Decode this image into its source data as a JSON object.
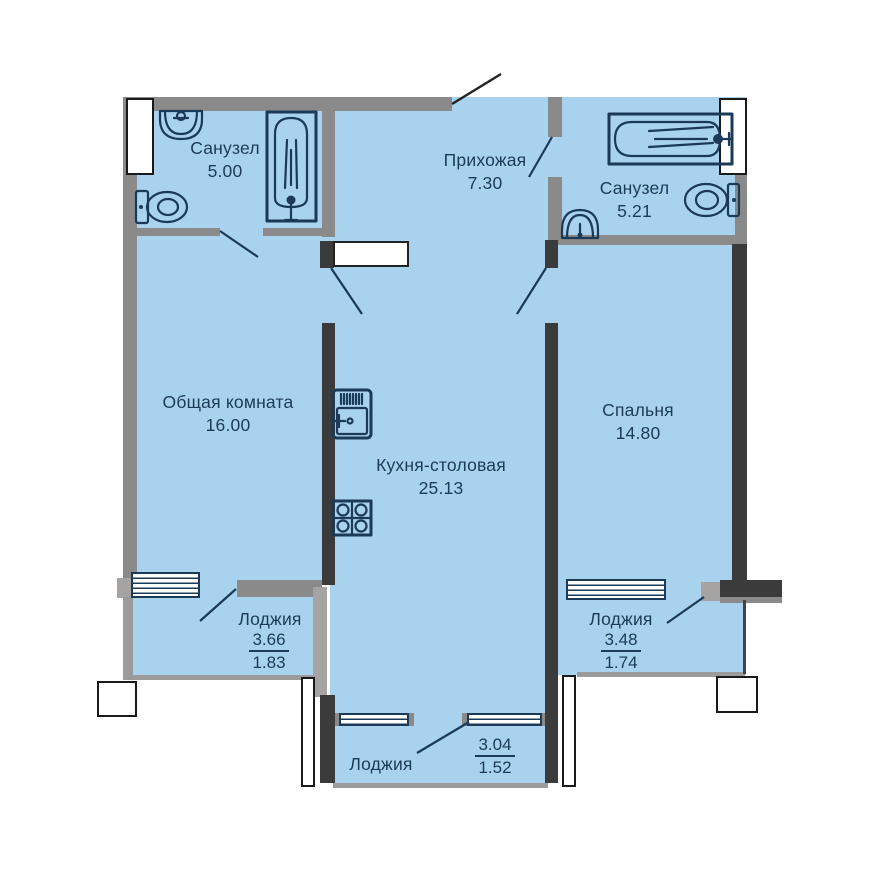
{
  "plan_type": "apartment-floor-plan",
  "rooms": {
    "bath1": {
      "name": "Санузел",
      "area": "5.00"
    },
    "hall": {
      "name": "Прихожая",
      "area": "7.30"
    },
    "bath2": {
      "name": "Санузел",
      "area": "5.21"
    },
    "living": {
      "name": "Общая комната",
      "area": "16.00"
    },
    "kitchen": {
      "name": "Кухня-столовая",
      "area": "25.13"
    },
    "bedroom": {
      "name": "Спальня",
      "area": "14.80"
    }
  },
  "loggias": {
    "left": {
      "name": "Лоджия",
      "area_total": "3.66",
      "area_coef": "1.83"
    },
    "right": {
      "name": "Лоджия",
      "area_total": "3.48",
      "area_coef": "1.74"
    },
    "bottom": {
      "name": "Лоджия",
      "area_total": "3.04",
      "area_coef": "1.52"
    }
  },
  "icons": {
    "fixtures": [
      "sink-icon",
      "toilet-icon",
      "bathtub-icon",
      "kitchen-sink-icon",
      "stove-icon"
    ]
  },
  "colors": {
    "floor_fill": "#a8d2ee",
    "wall_gray": "#8a8a8a",
    "wall_dark": "#3b3b3b",
    "outline_navy": "#1b3a57",
    "background": "#ffffff"
  }
}
